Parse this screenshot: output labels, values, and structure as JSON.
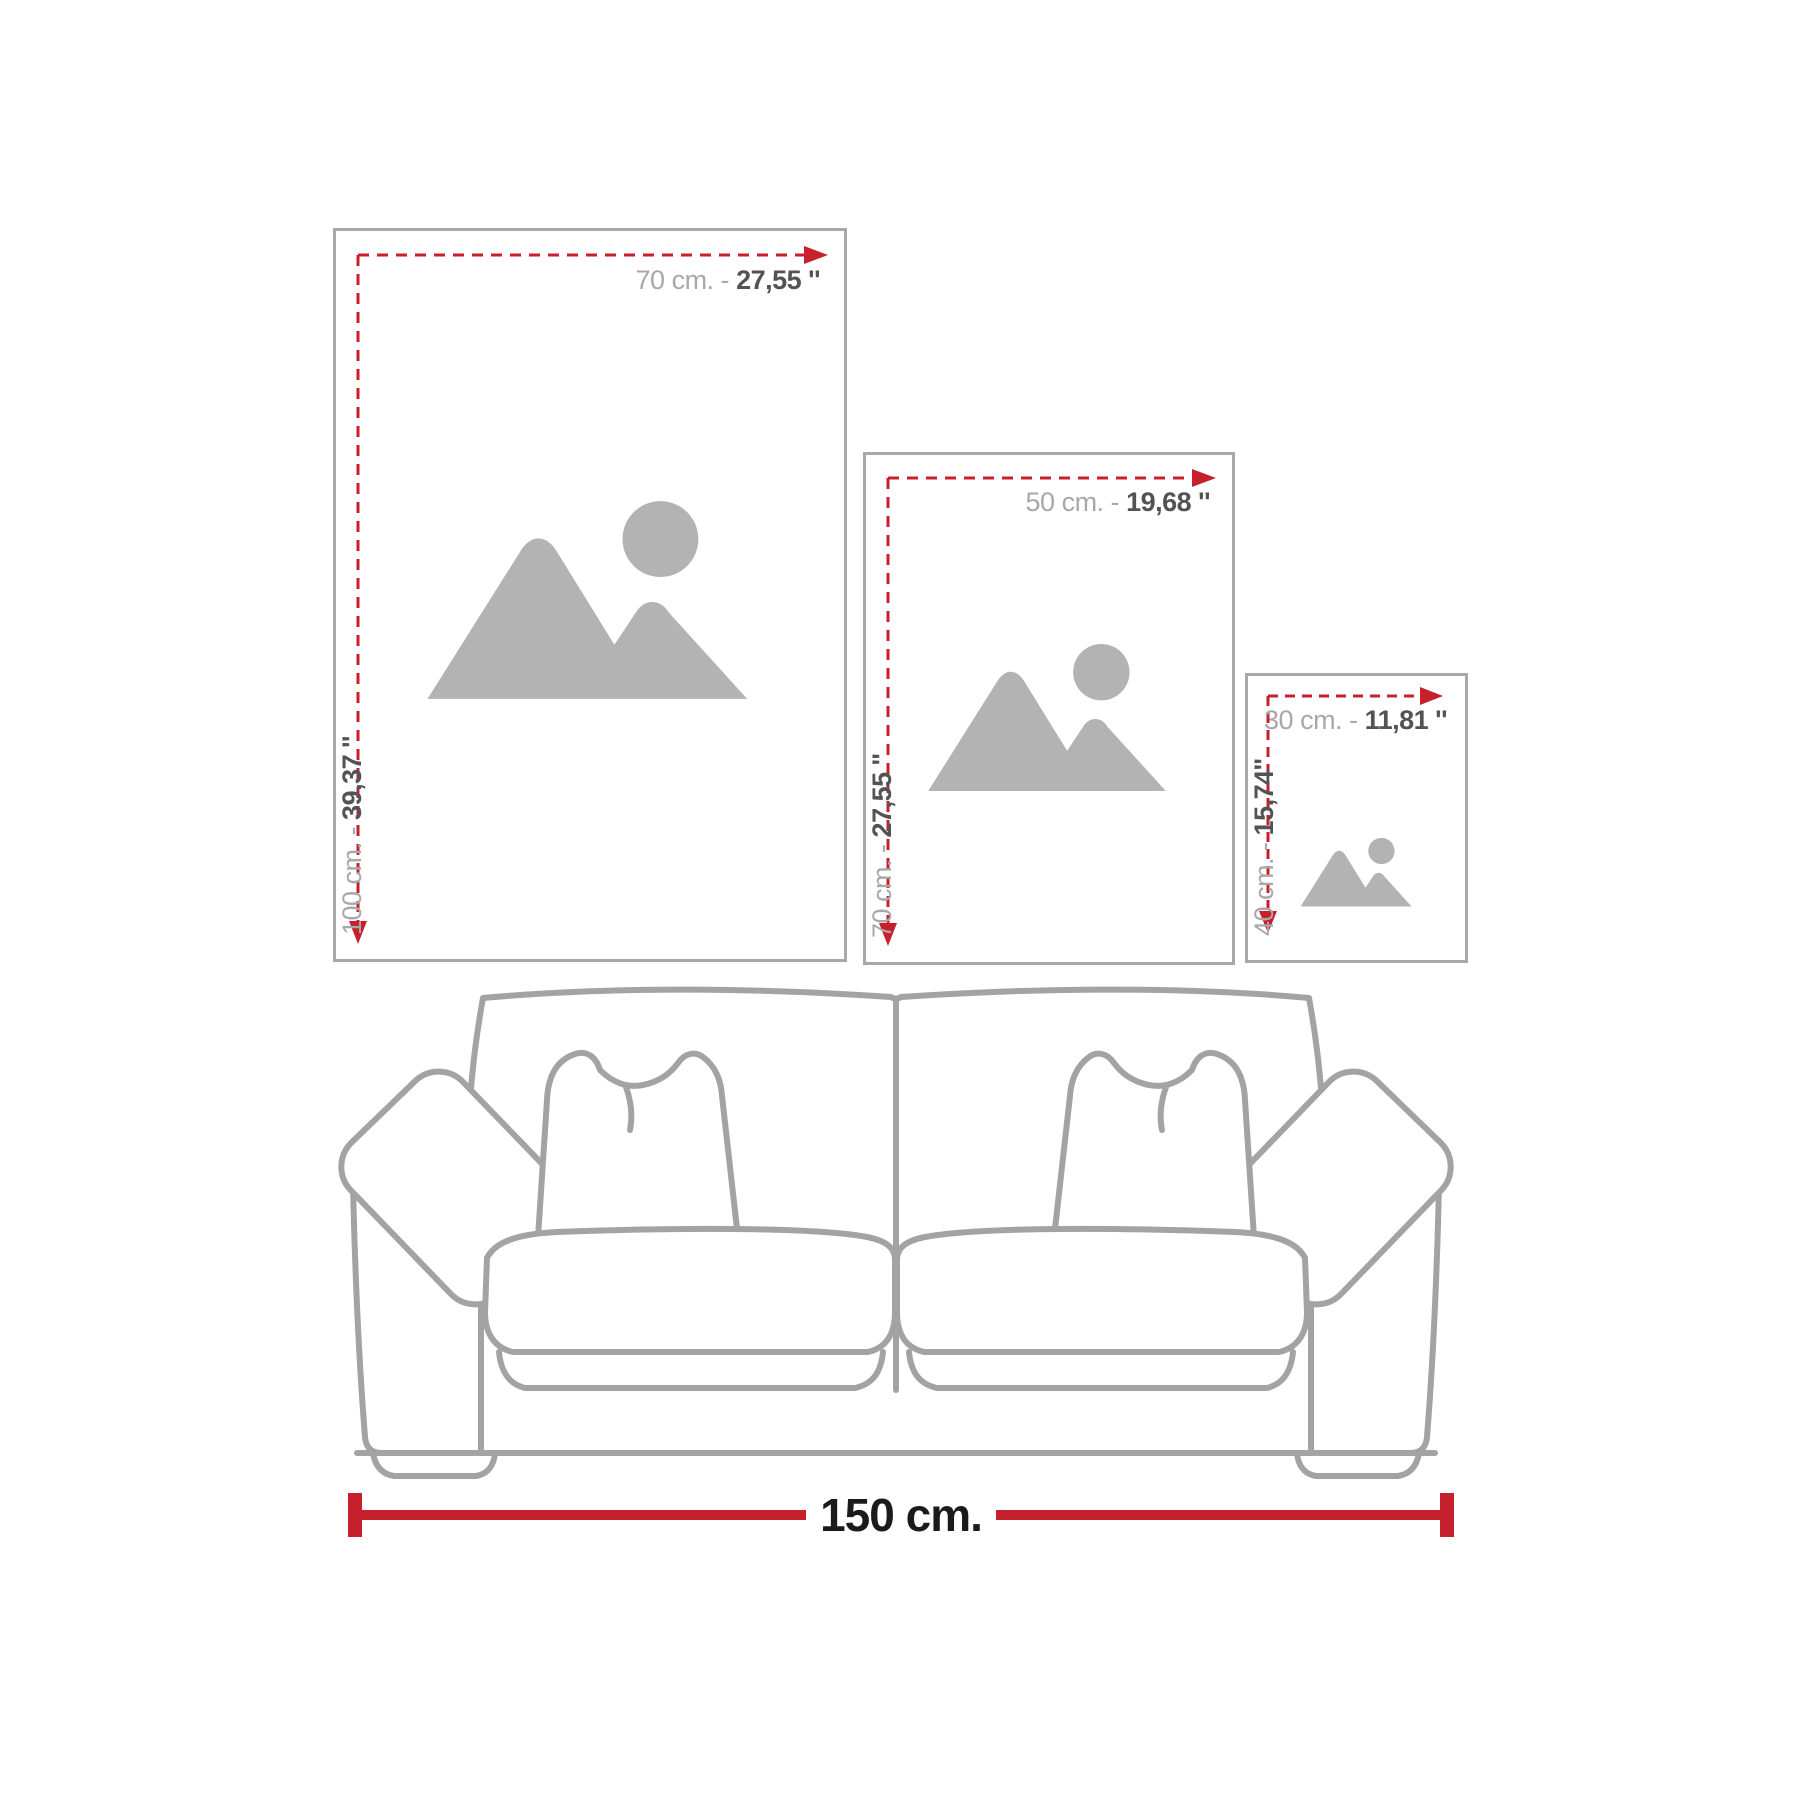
{
  "page": {
    "description": "Wall-art size guide showing three poster sizes above a two-seat sofa",
    "background": "#ffffff"
  },
  "colors": {
    "accent_red": "#c5202b",
    "frame_border": "#a8a8a8",
    "dimension_text_light": "#a8a8aa",
    "dimension_text_dark": "#525257",
    "placeholder_gray": "#b3b3b3",
    "sofa_line_gray": "#a3a3a3",
    "sofa_width_text": "#1b1b1b"
  },
  "frames": [
    {
      "size": "large",
      "width_cm": "70 cm. -",
      "width_in": "27,55 ''",
      "height_cm": "100 cm. -",
      "height_in": "39,37 ''"
    },
    {
      "size": "medium",
      "width_cm": "50 cm. -",
      "width_in": "19,68 ''",
      "height_cm": "70 cm. -",
      "height_in": "27,55 ''"
    },
    {
      "size": "small",
      "width_cm": "30 cm. -",
      "width_in": "11,81 ''",
      "height_cm": "40 cm. -",
      "height_in": "15,74''"
    }
  ],
  "sofa": {
    "width_label": "150 cm."
  },
  "icons": {
    "image_placeholder": "mountains-with-sun"
  }
}
